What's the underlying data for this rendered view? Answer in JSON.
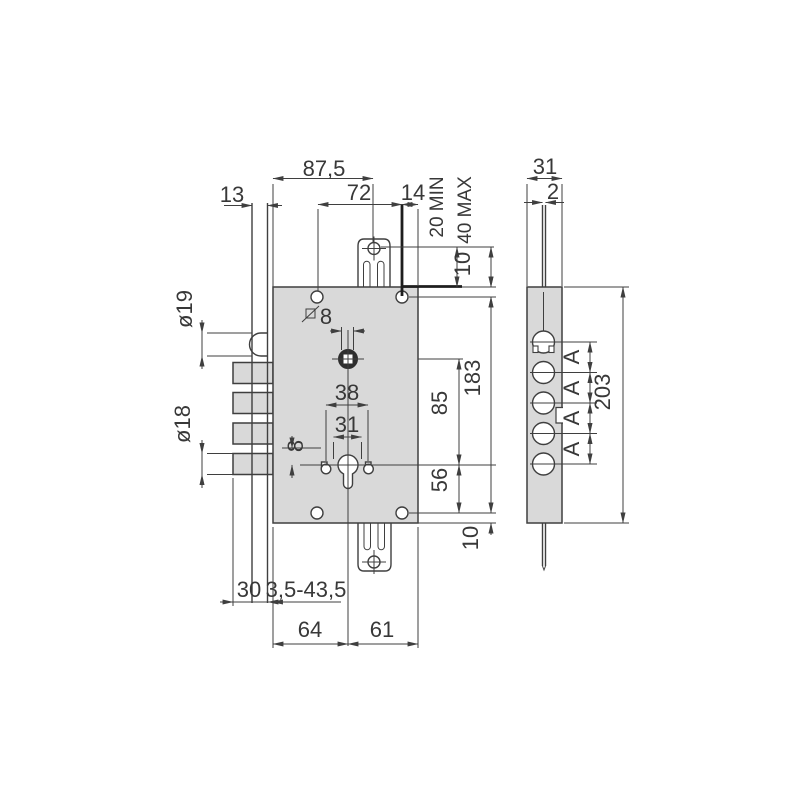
{
  "colors": {
    "body_fill": "#d9d9d9",
    "line": "#3f3f3f",
    "text": "#383838"
  },
  "front_view": {
    "dims": {
      "overall_width": "87,5",
      "hole_spacing_h": "72",
      "hole_to_edge": "14",
      "plate_offset": "13",
      "tab_min": "20 MIN",
      "tab_max": "40 MAX",
      "top_edge_to_hole": "10",
      "latch_diameter": "ø19",
      "bolt_diameter": "ø18",
      "spindle_square": "8",
      "cyl_hole_outer": "38",
      "cyl_hole_inner": "31",
      "hole_offset": "8",
      "spindle_to_cylinder": "85",
      "hole_span_vertical": "183",
      "cylinder_to_hole": "56",
      "bottom_edge_to_hole": "10",
      "bolt_throw": "30",
      "backset_range": "3,5-43,5",
      "edge_to_cylinder": "64",
      "cylinder_to_back": "61"
    }
  },
  "side_view": {
    "dims": {
      "body_width": "31",
      "faceplate_thickness": "2",
      "body_height": "203",
      "bolt_pitch": [
        "A",
        "A",
        "A",
        "A"
      ]
    }
  }
}
